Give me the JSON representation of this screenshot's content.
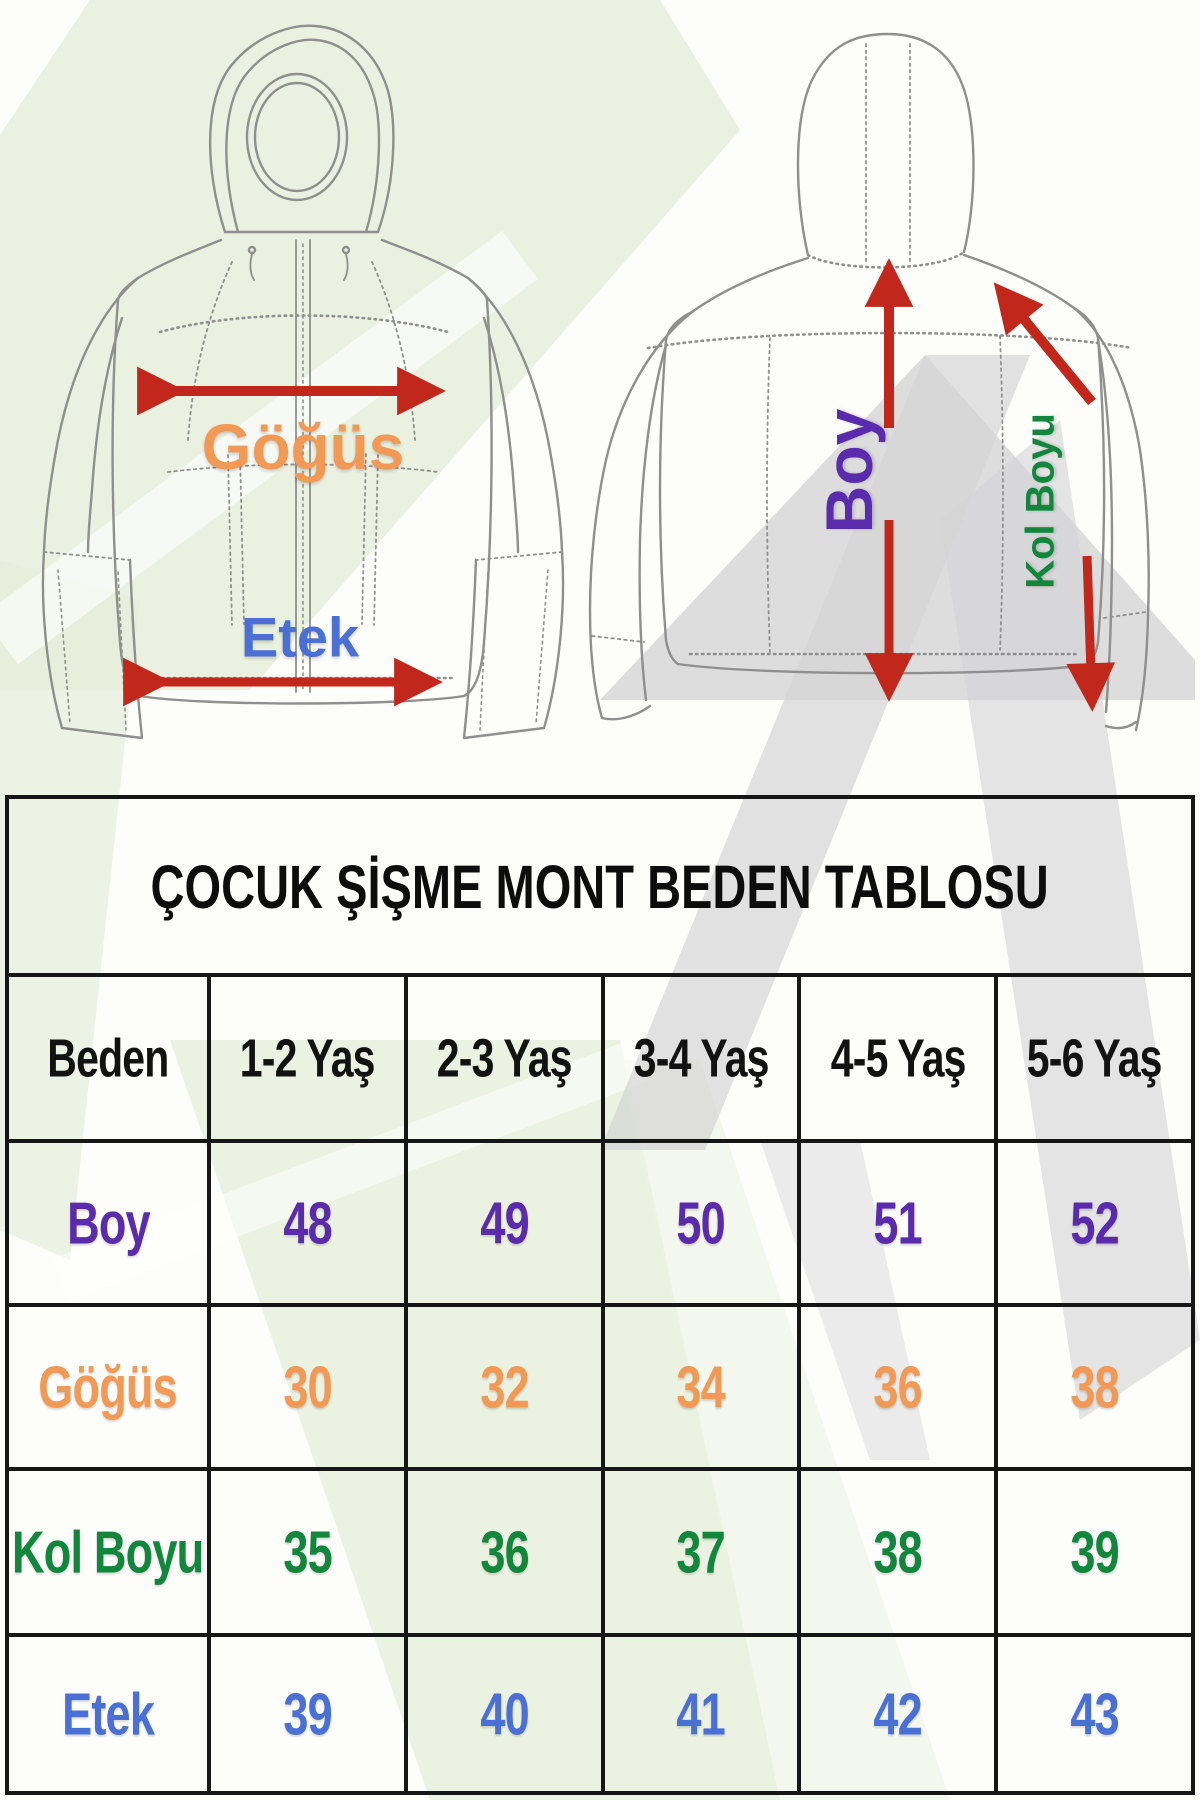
{
  "title": "ÇOCUK ŞİŞME MONT BEDEN TABLOSU",
  "diagram": {
    "front_view_labels": {
      "chest": "Göğüs",
      "hem": "Etek"
    },
    "back_view_labels": {
      "length": "Boy",
      "sleeve": "Kol Boyu"
    },
    "label_colors": {
      "chest": "#f29a55",
      "hem": "#4a70d6",
      "length": "#5b2bad",
      "sleeve": "#12873c"
    },
    "arrow_color": "#c1281b"
  },
  "table": {
    "title": "ÇOCUK ŞİŞME MONT BEDEN TABLOSU",
    "columns": [
      "Beden",
      "1-2 Yaş",
      "2-3 Yaş",
      "3-4 Yaş",
      "4-5 Yaş",
      "5-6 Yaş"
    ],
    "rows": [
      {
        "label": "Boy",
        "color": "#5b2bad",
        "values": [
          "48",
          "49",
          "50",
          "51",
          "52"
        ]
      },
      {
        "label": "Göğüs",
        "color": "#f29a55",
        "values": [
          "30",
          "32",
          "34",
          "36",
          "38"
        ]
      },
      {
        "label": "Kol Boyu",
        "color": "#12873c",
        "values": [
          "35",
          "36",
          "37",
          "38",
          "39"
        ]
      },
      {
        "label": "Etek",
        "color": "#4a70d6",
        "values": [
          "39",
          "40",
          "41",
          "42",
          "43"
        ]
      }
    ]
  },
  "chart_data": {
    "type": "table",
    "title": "ÇOCUK ŞİŞME MONT BEDEN TABLOSU",
    "columns": [
      "Beden",
      "1-2 Yaş",
      "2-3 Yaş",
      "3-4 Yaş",
      "4-5 Yaş",
      "5-6 Yaş"
    ],
    "rows": [
      {
        "measure": "Boy",
        "values": [
          48,
          49,
          50,
          51,
          52
        ]
      },
      {
        "measure": "Göğüs",
        "values": [
          30,
          32,
          34,
          36,
          38
        ]
      },
      {
        "measure": "Kol Boyu",
        "values": [
          35,
          36,
          37,
          38,
          39
        ]
      },
      {
        "measure": "Etek",
        "values": [
          39,
          40,
          41,
          42,
          43
        ]
      }
    ]
  },
  "colors": {
    "watermark_green": "#e6eeda",
    "watermark_gray": "#d4d4d6",
    "table_border": "#161616",
    "jacket_line": "#8f8f8f"
  }
}
